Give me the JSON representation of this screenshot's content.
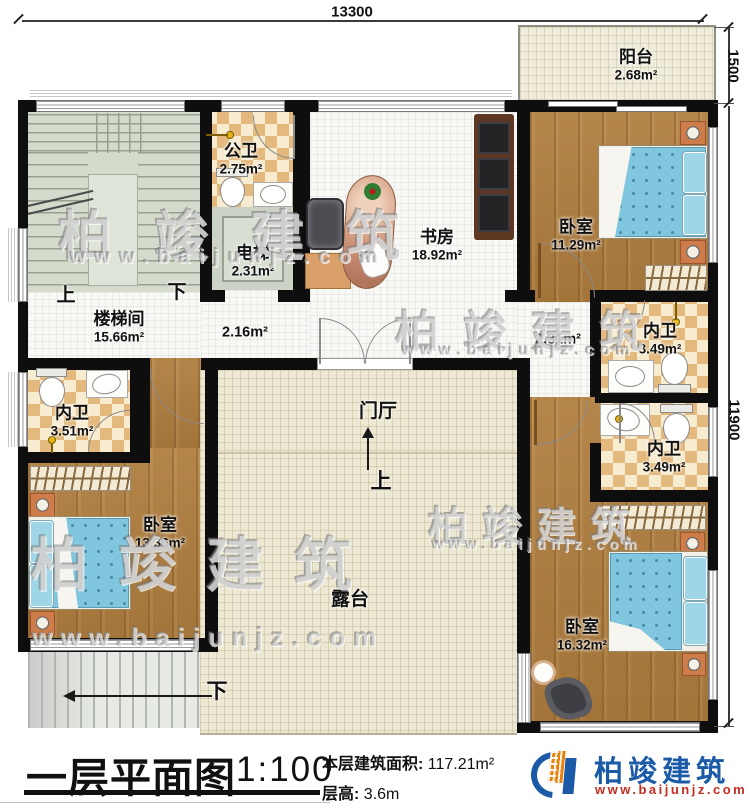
{
  "dimensions": {
    "top": "13300",
    "balcony_right": "1500",
    "main_right": "11900"
  },
  "rooms": {
    "balcony": {
      "name": "阳台",
      "area": "2.68m²"
    },
    "public_bath": {
      "name": "公卫",
      "area": "2.75m²"
    },
    "elevator": {
      "name": "电梯",
      "area": "2.31m²"
    },
    "study": {
      "name": "书房",
      "area": "18.92m²"
    },
    "bedroom_top_right": {
      "name": "卧室",
      "area": "11.29m²"
    },
    "stair_hall": {
      "name": "楼梯间",
      "area": "15.66m²"
    },
    "hall_center": {
      "area": "2.16m²"
    },
    "hall_right": {
      "area": "2.31m²"
    },
    "bath_top_right": {
      "name": "内卫",
      "area": "3.49m²"
    },
    "bath_left": {
      "name": "内卫",
      "area": "3.51m²"
    },
    "bath_bottom_right": {
      "name": "内卫",
      "area": "3.49m²"
    },
    "foyer": {
      "name": "门厅"
    },
    "bedroom_bottom_left": {
      "name": "卧室",
      "area": "13.36m²"
    },
    "terrace": {
      "name": "露台"
    },
    "bedroom_bottom_right": {
      "name": "卧室",
      "area": "16.32m²"
    }
  },
  "annotations": {
    "stair_up": "上",
    "stair_down": "下",
    "foyer_up": "上",
    "exterior_down": "下"
  },
  "title_block": {
    "title": "一层平面图",
    "scale": "1:100",
    "area_label": "本层建筑面积:",
    "area_value": "117.21m²",
    "height_label": "层高:",
    "height_value": "3.6m"
  },
  "logo": {
    "name": "柏竣建筑",
    "url": "www.baijunjz.com"
  },
  "watermark": {
    "text": "柏竣建筑",
    "url": "www.baijunjz.com"
  },
  "colors": {
    "wall": "#0e0e0e",
    "wood": "#b07e3f",
    "tile_light": "#f7ecd0",
    "tile_dark": "#e3b97e",
    "mattress_blue": "#7fc6de",
    "terrace_beige": "#ede8d3",
    "stair_sage": "#d4dbcd",
    "logo_blue": "#1a5aa6",
    "logo_orange": "#e8820c",
    "logo_red": "#c22b20"
  }
}
